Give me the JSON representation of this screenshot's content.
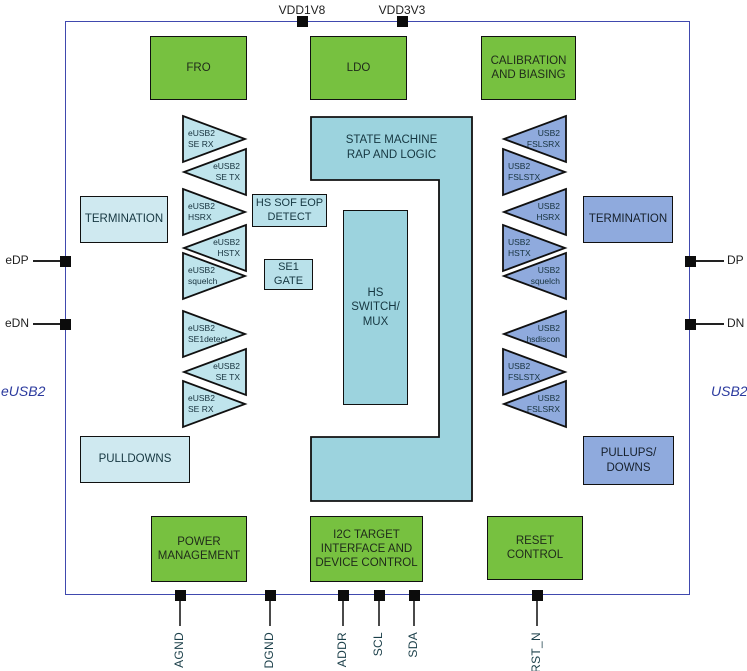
{
  "title": "eUSB2 to USB2 redriver functional block diagram",
  "pins": {
    "top": [
      "VDD1V8",
      "VDD3V3"
    ],
    "left": [
      "eDP",
      "eDN"
    ],
    "right": [
      "DP",
      "DN"
    ],
    "bottom": [
      "AGND",
      "DGND",
      "ADDR",
      "SCL",
      "SDA",
      "RST_N"
    ]
  },
  "bus_labels": {
    "left": "eUSB2",
    "right": "USB2"
  },
  "blocks": {
    "fro": "FRO",
    "ldo": "LDO",
    "calibration": "CALIBRATION\nAND BIASING",
    "termination_left": "TERMINATION",
    "termination_right": "TERMINATION",
    "hs_sof_eop": "HS SOF EOP\nDETECT",
    "se1_gate": "SE1\nGATE",
    "state_machine": "STATE MACHINE\nRAP AND LOGIC",
    "hs_switch_mux": "HS\nSWITCH/\nMUX",
    "pulldowns": "PULLDOWNS",
    "pullups_downs": "PULLUPS/\nDOWNS",
    "power_management": "POWER\nMANAGEMENT",
    "i2c": "I2C TARGET\nINTERFACE AND\nDEVICE CONTROL",
    "reset_control": "RESET\nCONTROL"
  },
  "amplifiers": {
    "left": [
      "eUSB2\nSE RX",
      "eUSB2\nSE TX",
      "eUSB2\nHSRX",
      "eUSB2\nHSTX",
      "eUSB2\nsquelch",
      "eUSB2\nSE1detect",
      "eUSB2\nSE TX",
      "eUSB2\nSE RX"
    ],
    "right": [
      "USB2\nFSLSRX",
      "USB2\nFSLSTX",
      "USB2\nHSRX",
      "USB2\nHSTX",
      "USB2\nsquelch",
      "USB2\nhsdiscon",
      "USB2\nFSLSTX",
      "USB2\nFSLSRX"
    ]
  },
  "colors": {
    "green": "#77c140",
    "pale_cyan": "#cfe9f0",
    "light_cyan": "#bfe4ec",
    "mid_cyan": "#9cd3de",
    "periwinkle": "#8faadd",
    "outer_border": "#4049ae"
  }
}
